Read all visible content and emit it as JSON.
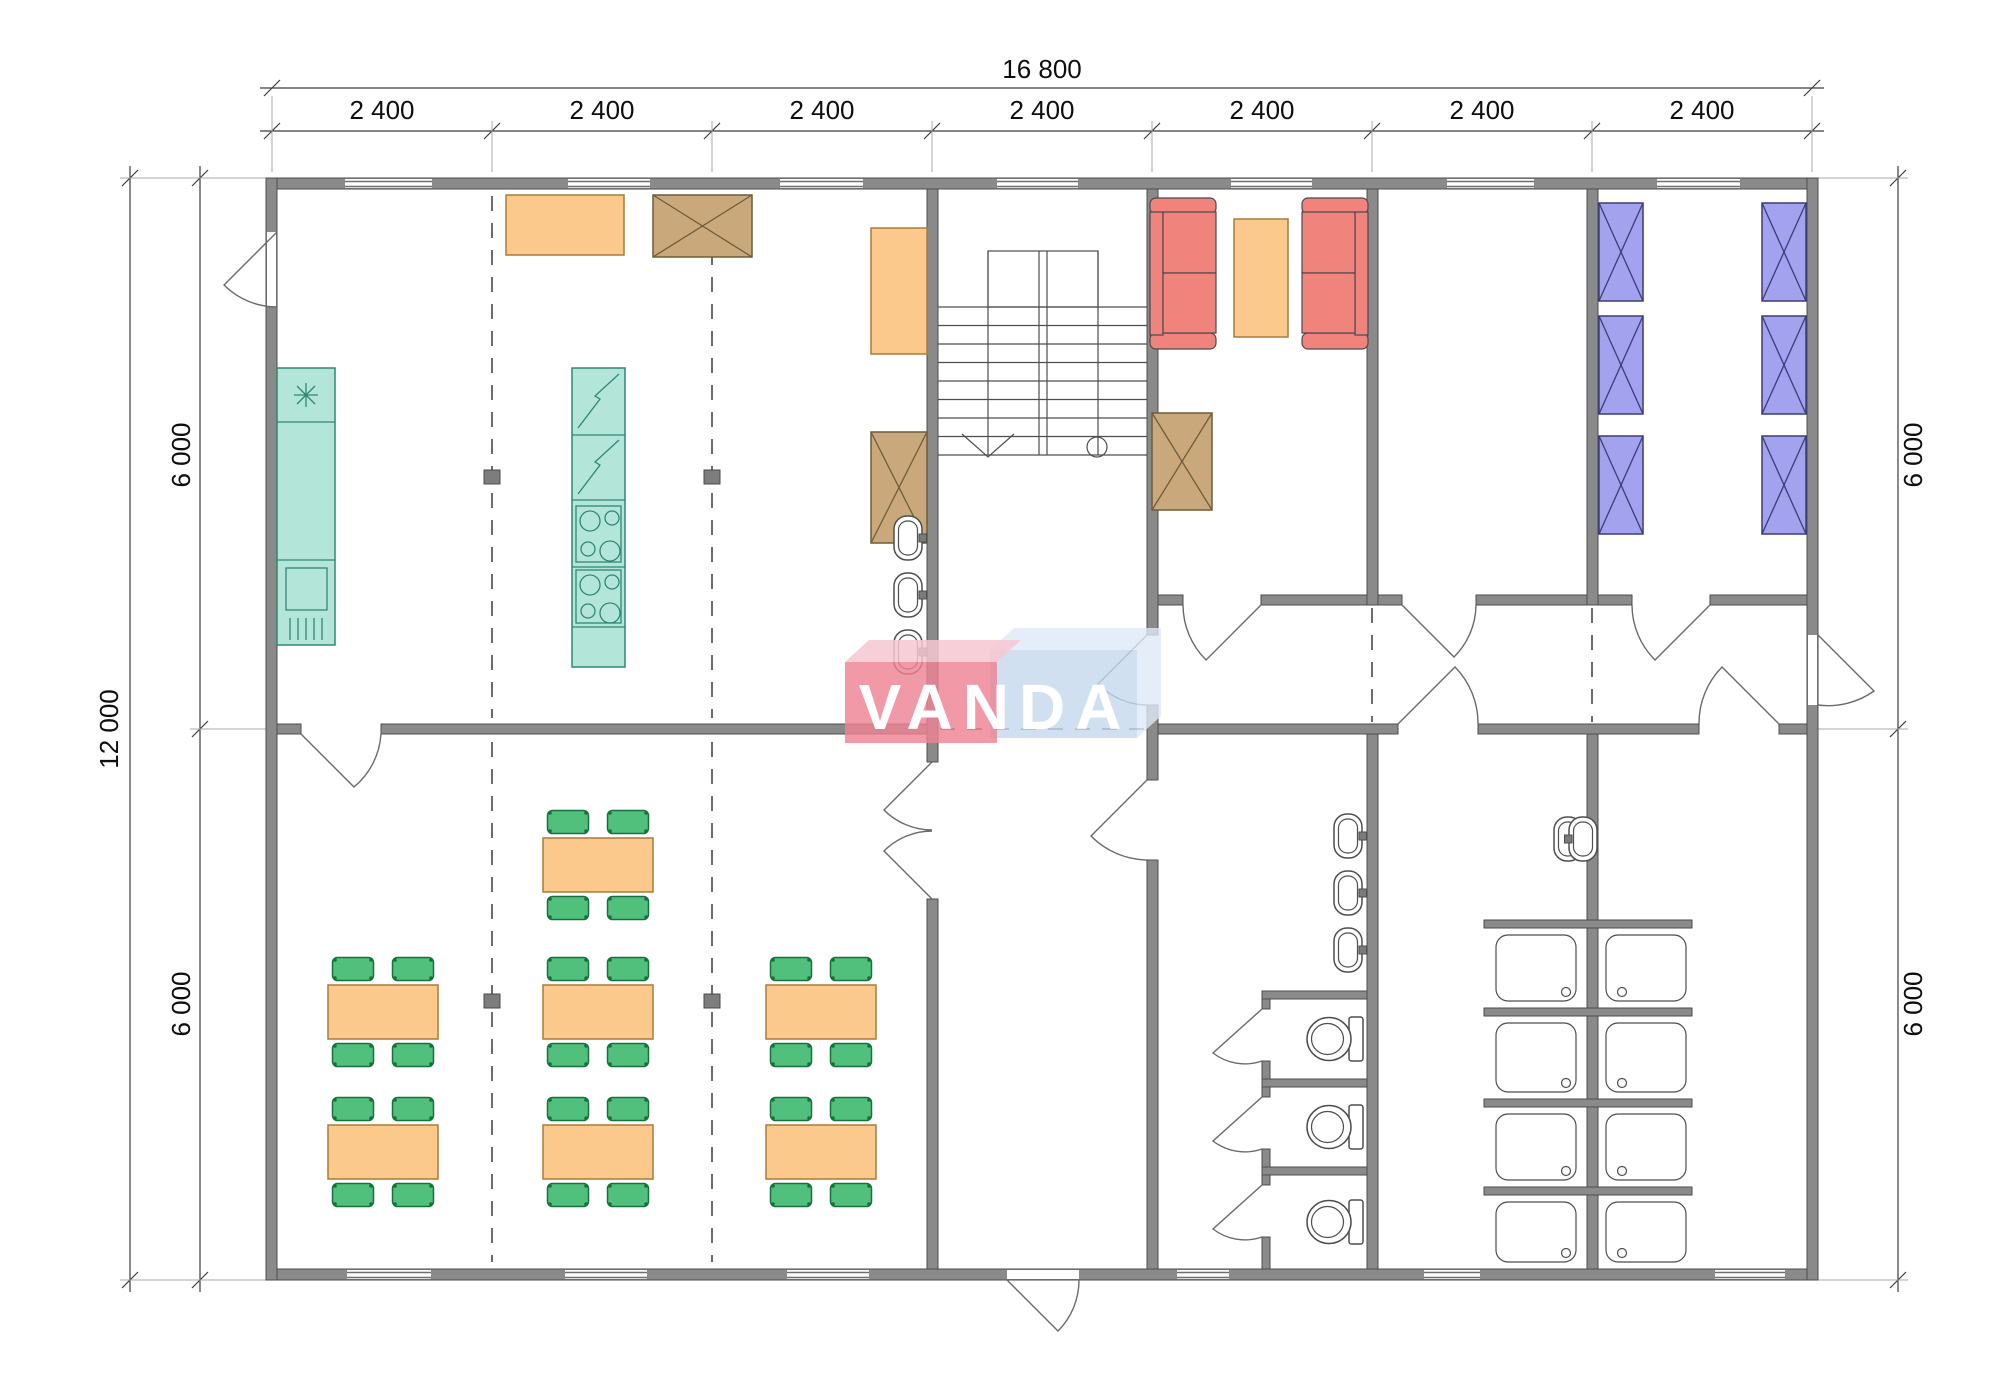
{
  "dimensions": {
    "top_total": "16 800",
    "top_bays": [
      "2 400",
      "2 400",
      "2 400",
      "2 400",
      "2 400",
      "2 400",
      "2 400"
    ],
    "left_total": "12 000",
    "left_segments": [
      "6 000",
      "6 000"
    ],
    "right_segments": [
      "6 000",
      "6 000"
    ]
  },
  "logo": {
    "text": "VANDA",
    "red_block_color": "#ee8292",
    "blue_block_color": "#c6d8ee",
    "letter_color": "#ffffff"
  },
  "palette": {
    "wall": "#8a8a8a",
    "kitchen_teal": "#b3e6d9",
    "furniture_orange": "#fbc98c",
    "cabinet_brown": "#c9a97c",
    "sofa_red": "#f1837d",
    "chair_green": "#50c07c",
    "bed_blue": "#a2a2ee"
  },
  "plan": {
    "grid": {
      "bays": 7,
      "bay_width_mm": 2400,
      "total_width_mm": 16800,
      "rows": 2,
      "row_depth_mm": 6000,
      "total_depth_mm": 12000
    },
    "fixture_counts": {
      "dining_tables": 7,
      "dining_chairs": 28,
      "kitchen_counters": 2,
      "kitchen_sinks": 1,
      "cooktops": 2,
      "sofas": 2,
      "coffee_tables": 1,
      "x_cabinets": 3,
      "serving_tables": 2,
      "bunk_beds": 6,
      "wash_basins": 8,
      "toilet_stalls": 3,
      "shower_cabins": 8,
      "stairs": 1,
      "windows": 13,
      "exterior_doors": 3
    }
  }
}
